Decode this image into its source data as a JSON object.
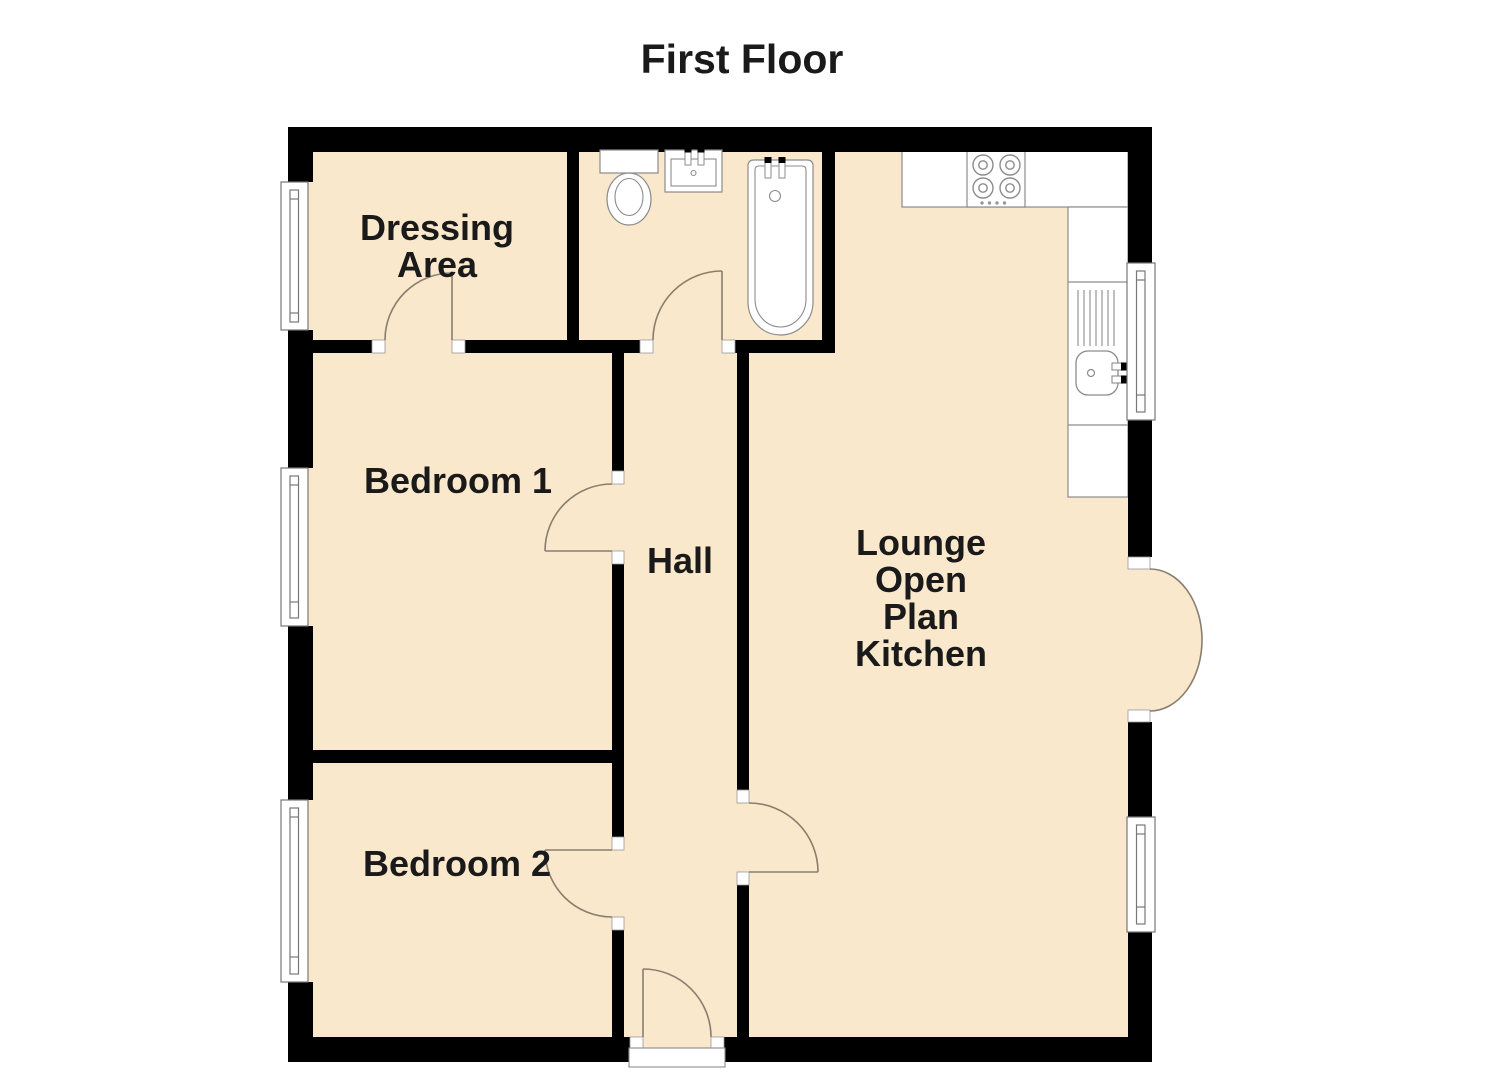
{
  "title": "First Floor",
  "rooms": {
    "dressing": {
      "line1": "Dressing",
      "line2": "Area"
    },
    "bedroom1": {
      "label": "Bedroom 1"
    },
    "bedroom2": {
      "label": "Bedroom 2"
    },
    "hall": {
      "label": "Hall"
    },
    "lounge": {
      "line1": "Lounge",
      "line2": "Open",
      "line3": "Plan",
      "line4": "Kitchen"
    }
  },
  "fixtures": {
    "bathroom": [
      "toilet",
      "wash-basin",
      "bath"
    ],
    "kitchen": [
      "counter",
      "hob-4-burners",
      "sink",
      "drainer"
    ]
  },
  "openings": {
    "windows_count": 5,
    "doors_count": 7,
    "french_doors": "lounge-east-wall",
    "entrance": "hall-south-wall"
  },
  "colors": {
    "floor": "#FAE8CC",
    "wall": "#000000",
    "fixture_outline": "#8C8C8C",
    "door_arc": "#8A7E6E",
    "text": "#1A1A1A",
    "background": "#FFFFFF"
  }
}
